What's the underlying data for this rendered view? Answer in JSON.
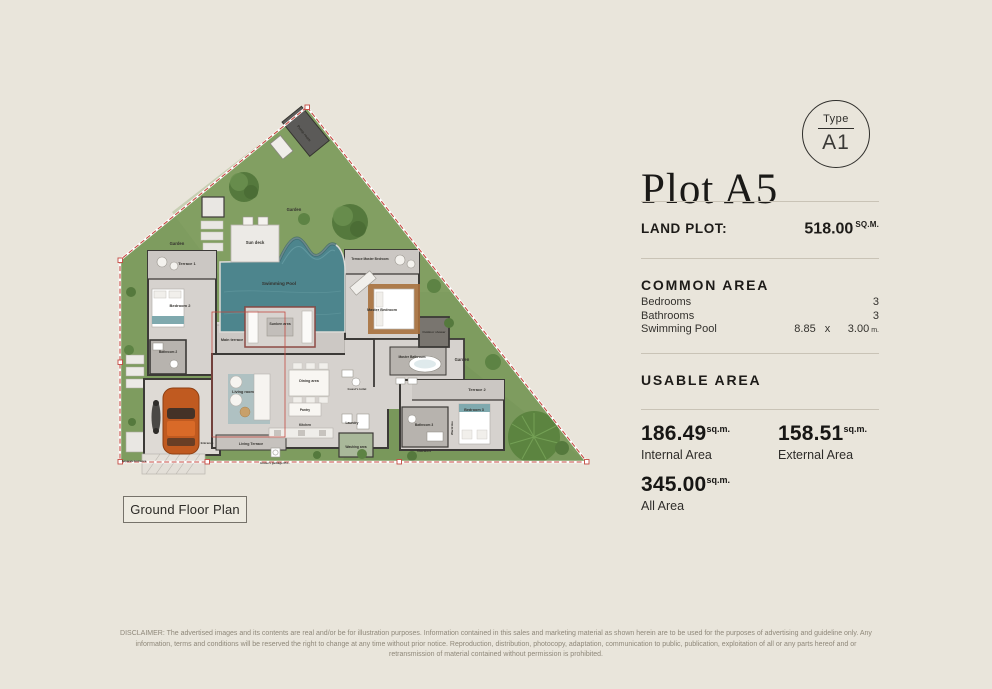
{
  "colors": {
    "page_background": "#e9e5db",
    "boundary_red": "#c44a42",
    "garden_green": "#7e9c5f",
    "tree_green": "#55793d",
    "pool_teal": "#4d858d",
    "floor_gray": "#d6d2ce",
    "car_orange": "#c05a20",
    "text_dark": "#1d1b18",
    "muted_text": "#8f887a"
  },
  "panel": {
    "title": "Plot A5",
    "type_badge": {
      "label": "Type",
      "value": "A1"
    },
    "land_plot": {
      "label": "LAND PLOT:",
      "value": "518.00",
      "unit": "SQ.M."
    },
    "common_area": {
      "heading": "COMMON AREA",
      "rows": [
        {
          "label": "Bedrooms",
          "value": "3"
        },
        {
          "label": "Bathrooms",
          "value": "3"
        }
      ],
      "pool_row": {
        "label": "Swimming Pool",
        "width": "8.85",
        "times": "x",
        "length": "3.00",
        "unit": "m."
      }
    },
    "usable_area": {
      "heading": "USABLE AREA",
      "stats": [
        {
          "value": "186.49",
          "unit": "sq.m.",
          "label": "Internal Area"
        },
        {
          "value": "158.51",
          "unit": "sq.m.",
          "label": "External Area"
        },
        {
          "value": "345.00",
          "unit": "sq.m.",
          "label": "All Area"
        }
      ]
    }
  },
  "plan": {
    "caption": "Ground Floor Plan",
    "labels": {
      "pump_room": "Pump room",
      "garden": "Garden",
      "sun_deck": "Sun deck",
      "swimming_pool": "Swimming Pool",
      "sunken_area": "Sunken area",
      "main_terrace": "Main terrace",
      "terrace_1": "Terrace 1",
      "bedroom_2": "Bedroom 2",
      "bathroom_2": "Bathroom 2",
      "terrace_master_bedroom": "Terrace Master Bedroom",
      "master_bedroom": "Master Bedroom",
      "master_bathroom": "Master Bathroom",
      "outdoor_shower": "Outdoor shower",
      "terrace_2": "Terrace 2",
      "bedroom_3": "Bedroom 3",
      "bathroom_3": "Bathroom 3",
      "wardrobe": "Wardrobe",
      "living_room": "Living room",
      "dining_area": "Dining area",
      "pantry": "Pantry",
      "kitchen": "Kitchen",
      "guests_toilet": "Guest's toilet",
      "laundry": "Laundry",
      "washing_area": "Washing area",
      "living_terrace": "Living Terrace",
      "entrance": "Entrance",
      "separate_entrance": "Separate Entrance",
      "garbage": "House's garbage 65 L."
    }
  },
  "disclaimer": "DISCLAIMER: The advertised images and its contents are real and/or be for illustration purposes. Information contained in this sales and marketing material as shown herein are to be used for the purposes of advertising and guideline only. Any information, terms and conditions will be reserved the right to change at any time without prior notice. Reproduction, distribution, photocopy, adaptation, communication to public, publication, exploitation of all or any parts hereof and or retransmission of material contained without permission is prohibited."
}
